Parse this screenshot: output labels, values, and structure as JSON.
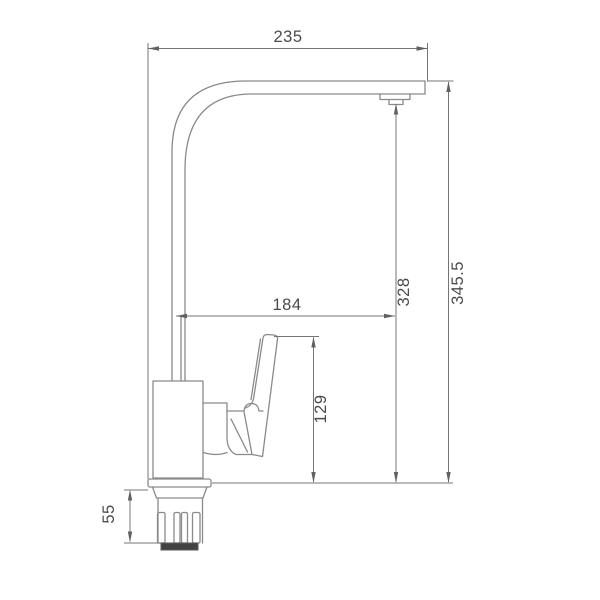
{
  "drawing": {
    "kind": "faucet-dimension-drawing",
    "view": "side"
  },
  "dimensions": {
    "top_width": "235",
    "overall_height": "345.5",
    "outlet_height": "328",
    "spout_reach": "184",
    "handle_height": "129",
    "shank_height": "55"
  },
  "colors": {
    "background": "#ffffff",
    "product_line": "#8a8a8a",
    "dimension_line": "#757575",
    "arrow": "#616161",
    "text": "#4a4a4a",
    "shank_tip_band": "#424242"
  }
}
